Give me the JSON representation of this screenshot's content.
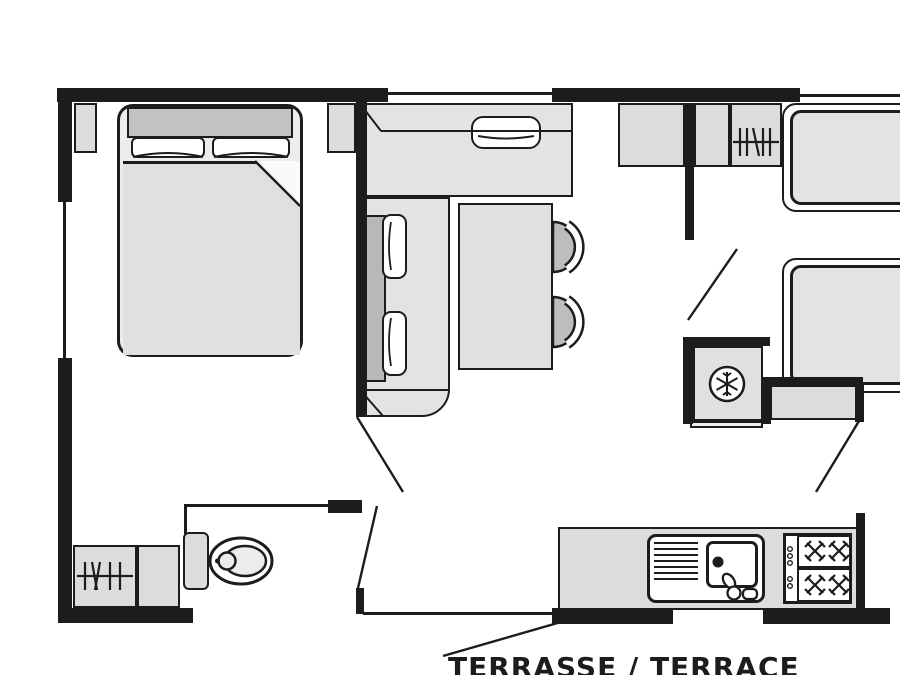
{
  "plan": {
    "terrace_label": "TERRASSE / TERRACE",
    "type": "mobile-home floor plan"
  },
  "colors": {
    "background": "#ffffff",
    "wall": "#1c1c1c",
    "furniture_light": "#e3e3e3",
    "furniture_medium": "#c3c3c3",
    "backrest_gray": "#b8b8b8",
    "counter_gray": "#dcdcdc",
    "fixture_white": "#ffffff"
  },
  "icons": {
    "snowflake-icon": "fridge / freezer symbol",
    "hanging-rail-icon": "wardrobe hanging rail symbol",
    "burner-icon": "gas hob burner cross",
    "door-swing-icon": "open door diagonal line",
    "toilet-icon": "WC bowl and cistern"
  },
  "rooms": {
    "bedroom": [
      "double-bed",
      "headboard",
      "pillows",
      "blanket",
      "nightstand-left",
      "nightstand-right"
    ],
    "living": [
      "l-shaped-sofa",
      "seat-cushions",
      "dining-table",
      "chair-1",
      "chair-2"
    ],
    "twin-room": [
      "cabinet",
      "cabinet",
      "wardrobe",
      "single-bed-top",
      "single-bed-bottom",
      "shelf",
      "fridge"
    ],
    "bathroom": [
      "wardrobe",
      "cabinet",
      "toilet"
    ],
    "kitchen": [
      "counter",
      "sink-unit",
      "drainer",
      "basin",
      "faucet",
      "gas-hob"
    ]
  }
}
